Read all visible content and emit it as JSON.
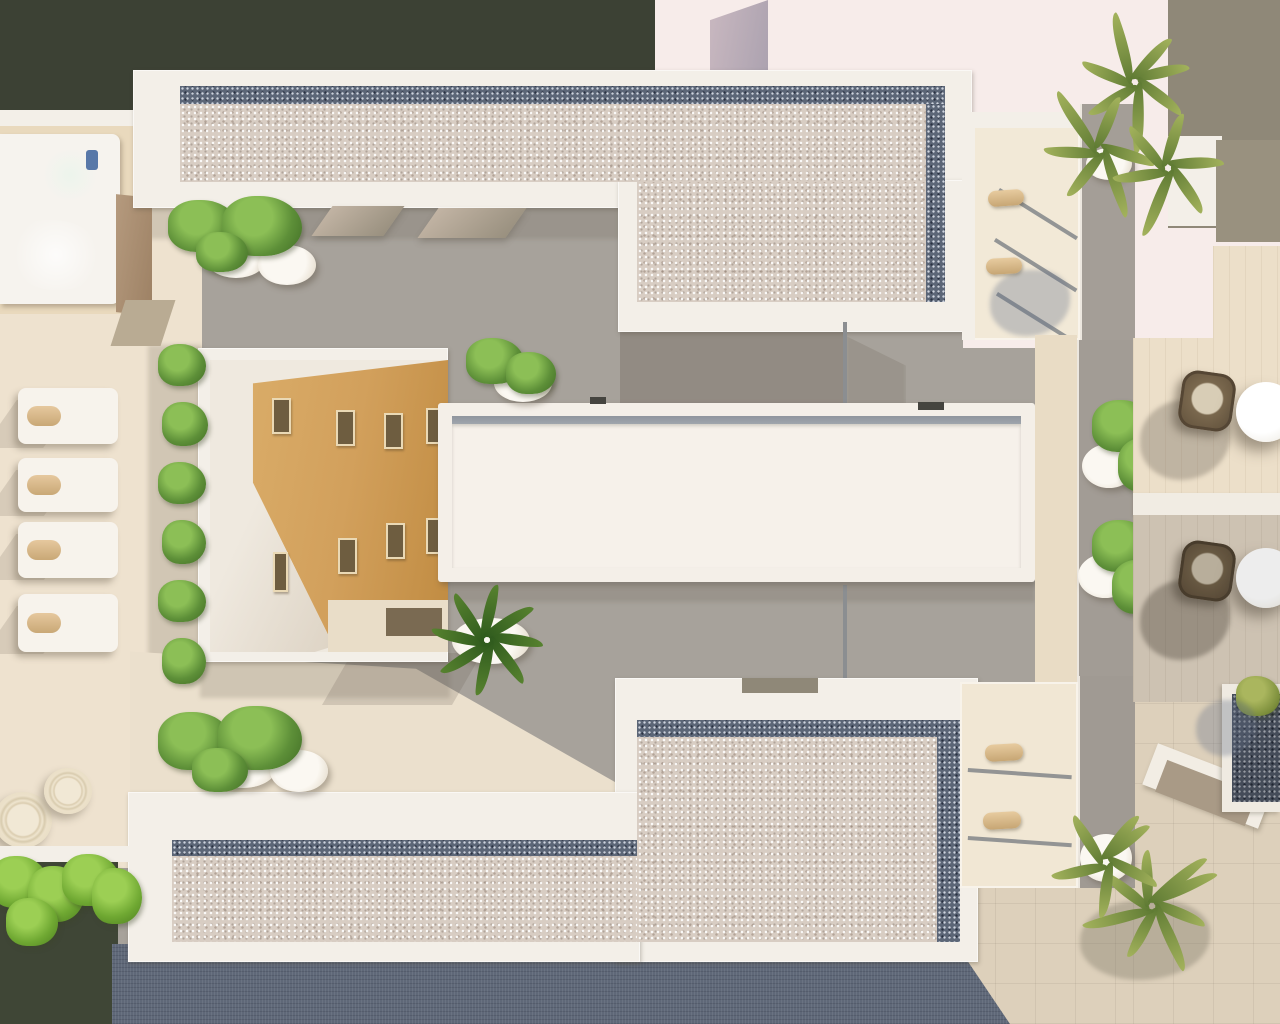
{
  "meta": {
    "title": "Aerial 3D architectural render of rooftop terraces and courtyard",
    "image_type": "photorealistic top-down render",
    "visible_text": []
  },
  "palette": {
    "olive_dark": "#3c4134",
    "pink_background": "#f7ecea",
    "taupe_block": "#8f8878",
    "white_building": "#f3efe8",
    "gravel_light": "#d8cdc3",
    "gravel_dark_border": "#5c6677",
    "paving_gray": "#a7a29b",
    "terrace_beige": "#eee2cf",
    "plaza_beige": "#ddd0bb",
    "road_slate": "#5f6878",
    "pool_water_green": "#a9d2ba",
    "courtyard_ochre": "#d2a05c",
    "plant_green": "#5d8f38",
    "palm_olive": "#93a24f",
    "lounger_pillow_tan": "#d9b98f",
    "wicker_chair_brown": "#6b5a43"
  },
  "inventory": {
    "gravel_roof_buildings": 3,
    "central_flat_roof": 1,
    "jacuzzi_pool": 1,
    "sun_loungers_left_terrace": 4,
    "sun_loungers_upper_balcony": 2,
    "sun_loungers_lower_terrace": 2,
    "round_poufs": 2,
    "bistro_tables": 2,
    "wicker_chairs": 2,
    "palm_trees": 4,
    "potted_bushes": 8,
    "courtyard_window_slots": 8
  }
}
